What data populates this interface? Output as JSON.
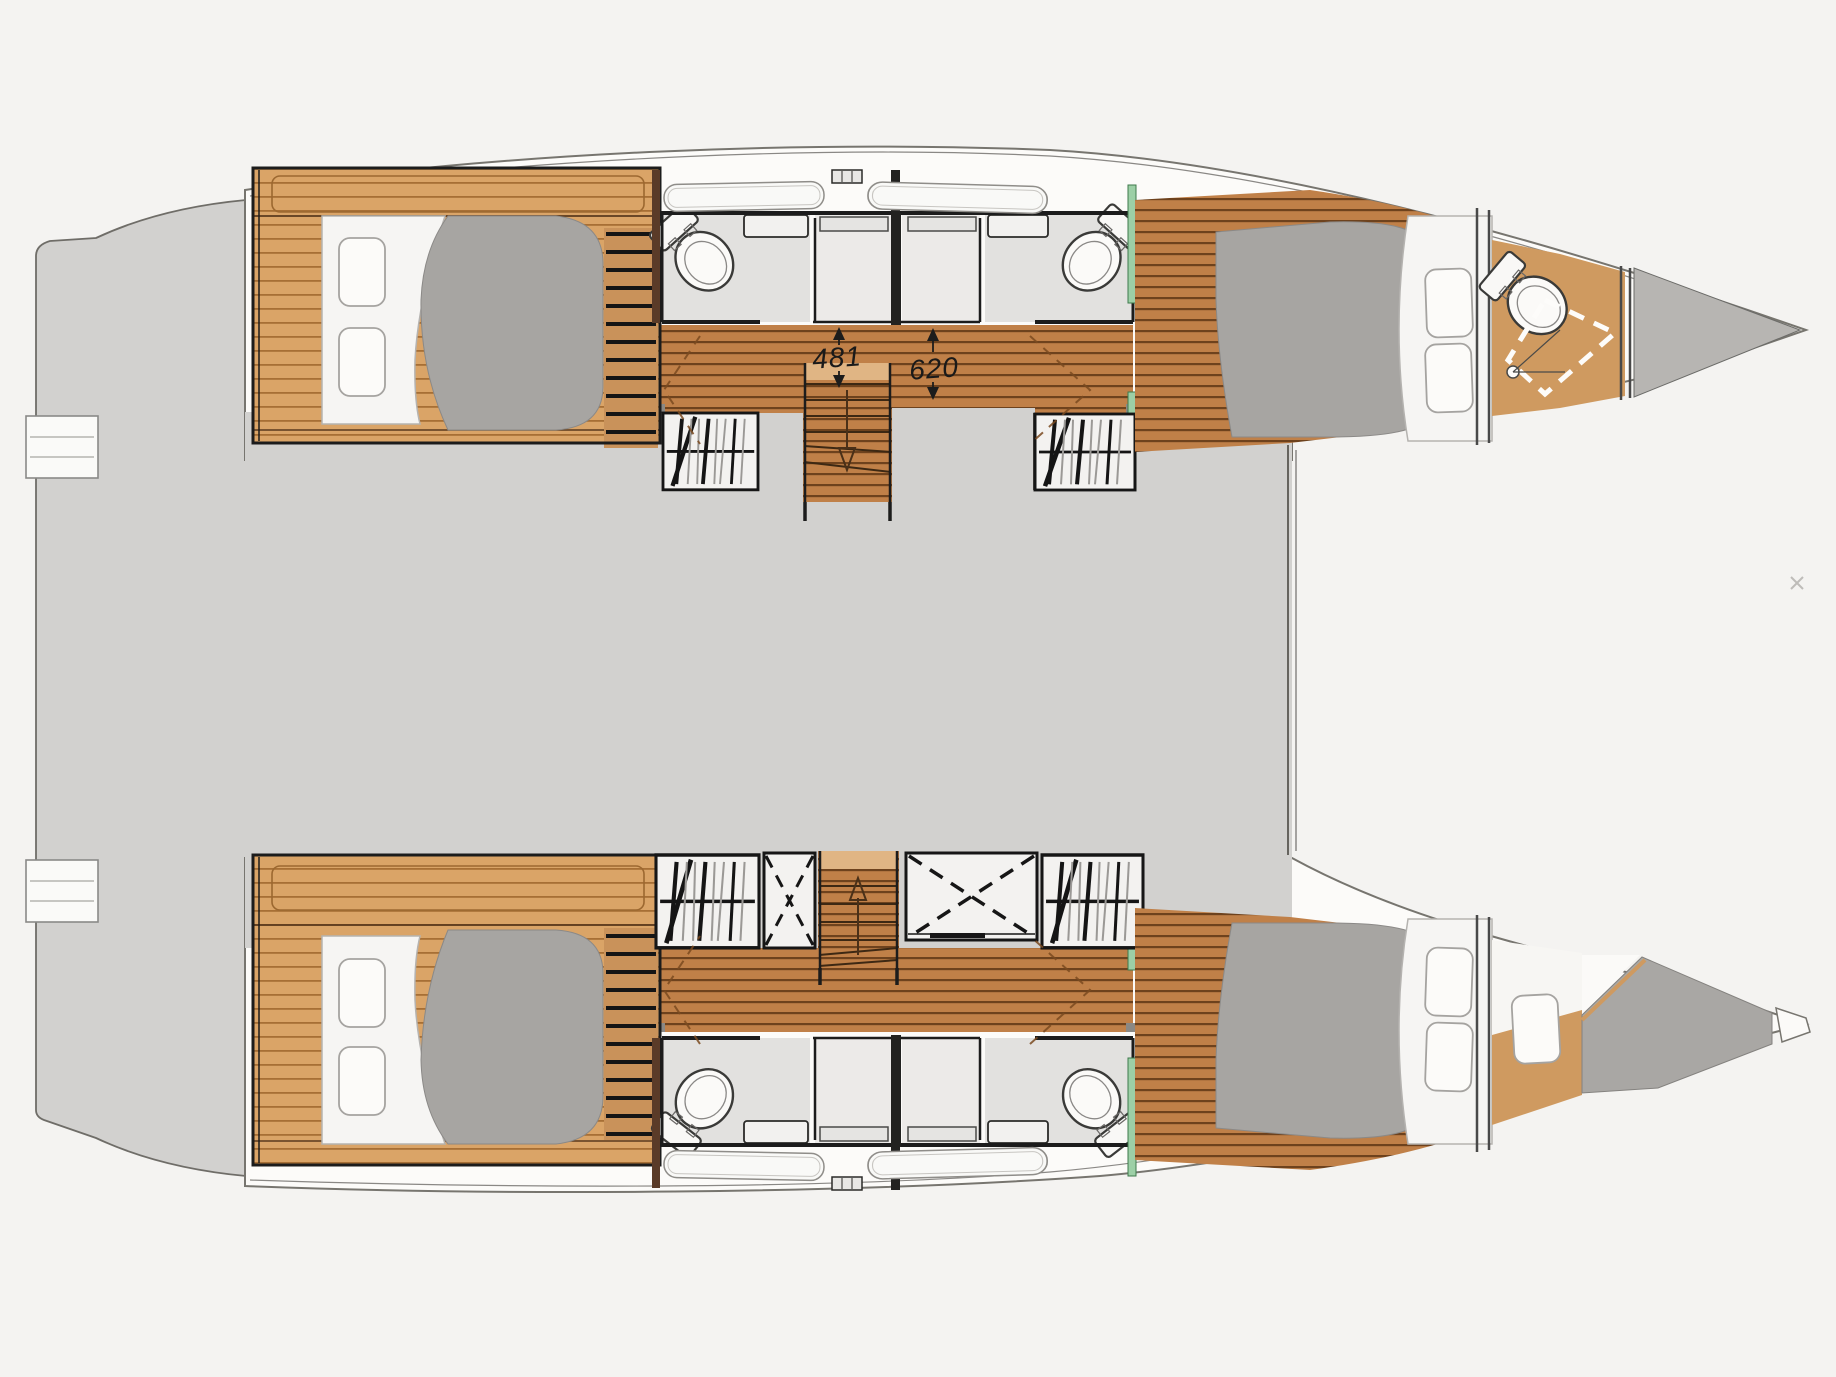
{
  "canvas": {
    "width": 1836,
    "height": 1377,
    "background": "#f4f3f1"
  },
  "plan": {
    "type": "catamaran-deck-plan",
    "dimension_labels": {
      "aft_passage": "481",
      "fwd_passage": "620"
    },
    "colors": {
      "hull": "#fcfbf9",
      "deck_gray": "#d2d1cf",
      "bathroom_floor": "#e2e1df",
      "shower_floor": "#eceae8",
      "wood_dark": "#c08048",
      "wood_light": "#daa467",
      "wood_plain": "#cf9a60",
      "bed_gray": "#a7a5a2",
      "bow_locker_gray": "#b7b5b2",
      "berth_gray": "#a9a7a4",
      "wall_black": "#1c1c1c",
      "outline_gray": "#6f6d68",
      "accent_green": "#9ccfa6",
      "dim_text": "#1a1a1a"
    }
  }
}
